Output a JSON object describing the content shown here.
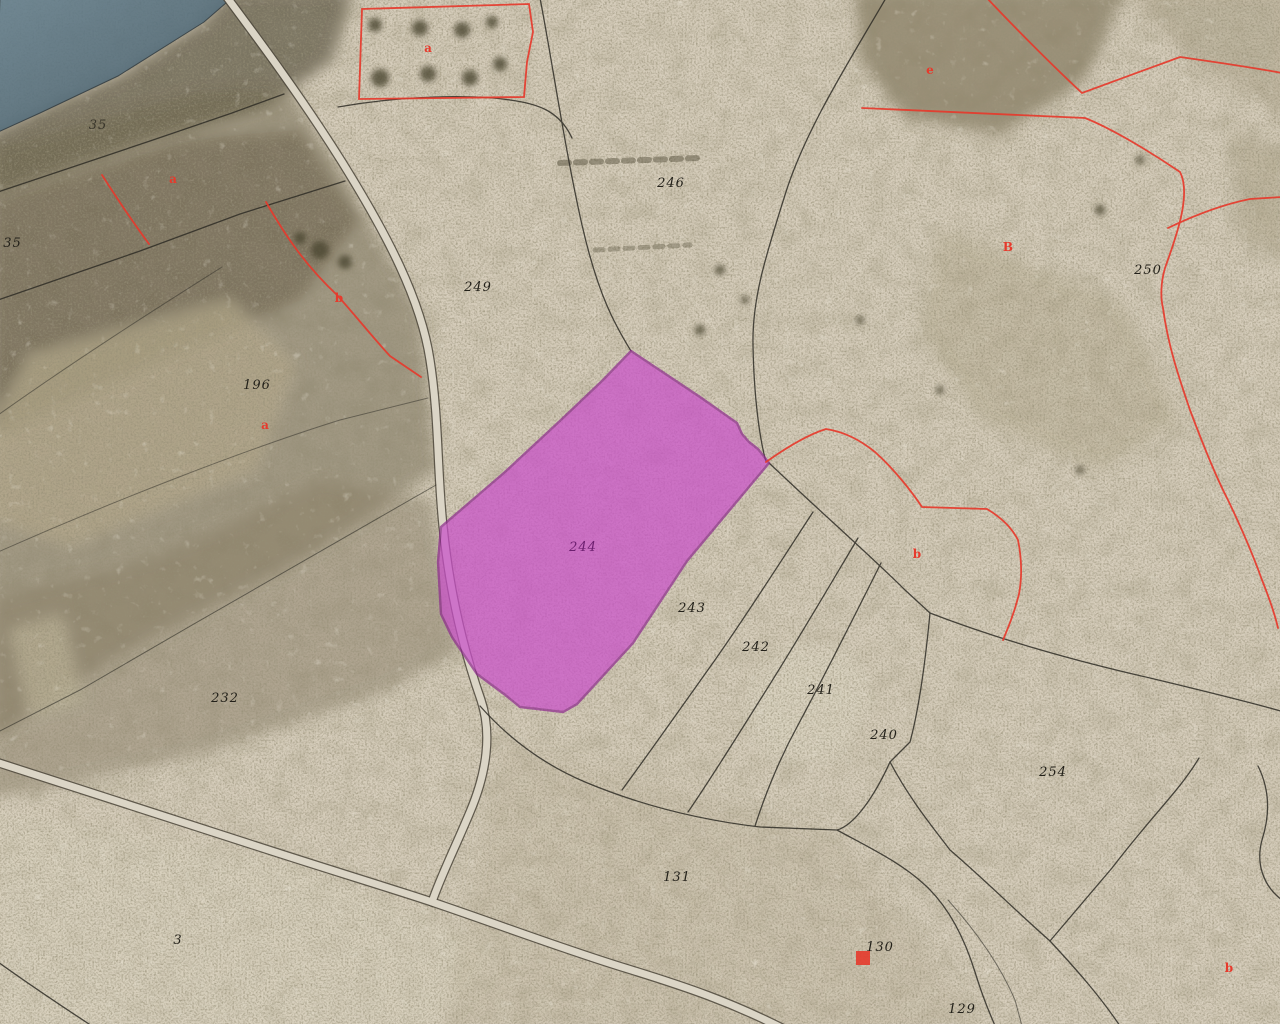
{
  "map": {
    "kind": "cadastral-parcel-overlay-on-aerial-imagery",
    "selected_parcel": {
      "number": "244"
    },
    "colors": {
      "highlight_fill": "#c94fc9",
      "highlight_border": "#8e2b8e",
      "boundary_red": "#e63a2c",
      "boundary_black": "#2f2d26",
      "road_fill": "#dbd5c6",
      "road_casing": "#4d483c",
      "label_color": "#23211a",
      "selected_label_color": "#6d2070",
      "water_overlay": "#5b7585"
    },
    "parcel_labels": [
      {
        "text": "246",
        "x": 671,
        "y": 187
      },
      {
        "text": "249",
        "x": 478,
        "y": 291
      },
      {
        "text": "250",
        "x": 1148,
        "y": 274
      },
      {
        "text": "196",
        "x": 257,
        "y": 389
      },
      {
        "text": "135",
        "x": -6,
        "y": 247,
        "anchor": "start"
      },
      {
        "text": "35",
        "x": 98,
        "y": 129,
        "opacity": 0.75
      },
      {
        "text": "244",
        "x": 583,
        "y": 551,
        "color": "#6d2070"
      },
      {
        "text": "243",
        "x": 692,
        "y": 612
      },
      {
        "text": "242",
        "x": 756,
        "y": 651
      },
      {
        "text": "241",
        "x": 821,
        "y": 694
      },
      {
        "text": "240",
        "x": 884,
        "y": 739
      },
      {
        "text": "254",
        "x": 1053,
        "y": 776
      },
      {
        "text": "232",
        "x": 225,
        "y": 702
      },
      {
        "text": "131",
        "x": 677,
        "y": 881
      },
      {
        "text": "130",
        "x": 880,
        "y": 951
      },
      {
        "text": "129",
        "x": 962,
        "y": 1013
      },
      {
        "text": "3",
        "x": 178,
        "y": 944
      }
    ],
    "red_letters": [
      {
        "text": "a",
        "x": 428,
        "y": 52
      },
      {
        "text": "e",
        "x": 930,
        "y": 74
      },
      {
        "text": "B",
        "x": 1008,
        "y": 251
      },
      {
        "text": "a",
        "x": 173,
        "y": 183
      },
      {
        "text": "b",
        "x": 339,
        "y": 302
      },
      {
        "text": "a",
        "x": 265,
        "y": 429
      },
      {
        "text": "b",
        "x": 917,
        "y": 558
      },
      {
        "text": "b",
        "x": 1229,
        "y": 972
      }
    ],
    "red_markers": [
      {
        "x": 856,
        "y": 951,
        "w": 14,
        "h": 14
      }
    ]
  }
}
